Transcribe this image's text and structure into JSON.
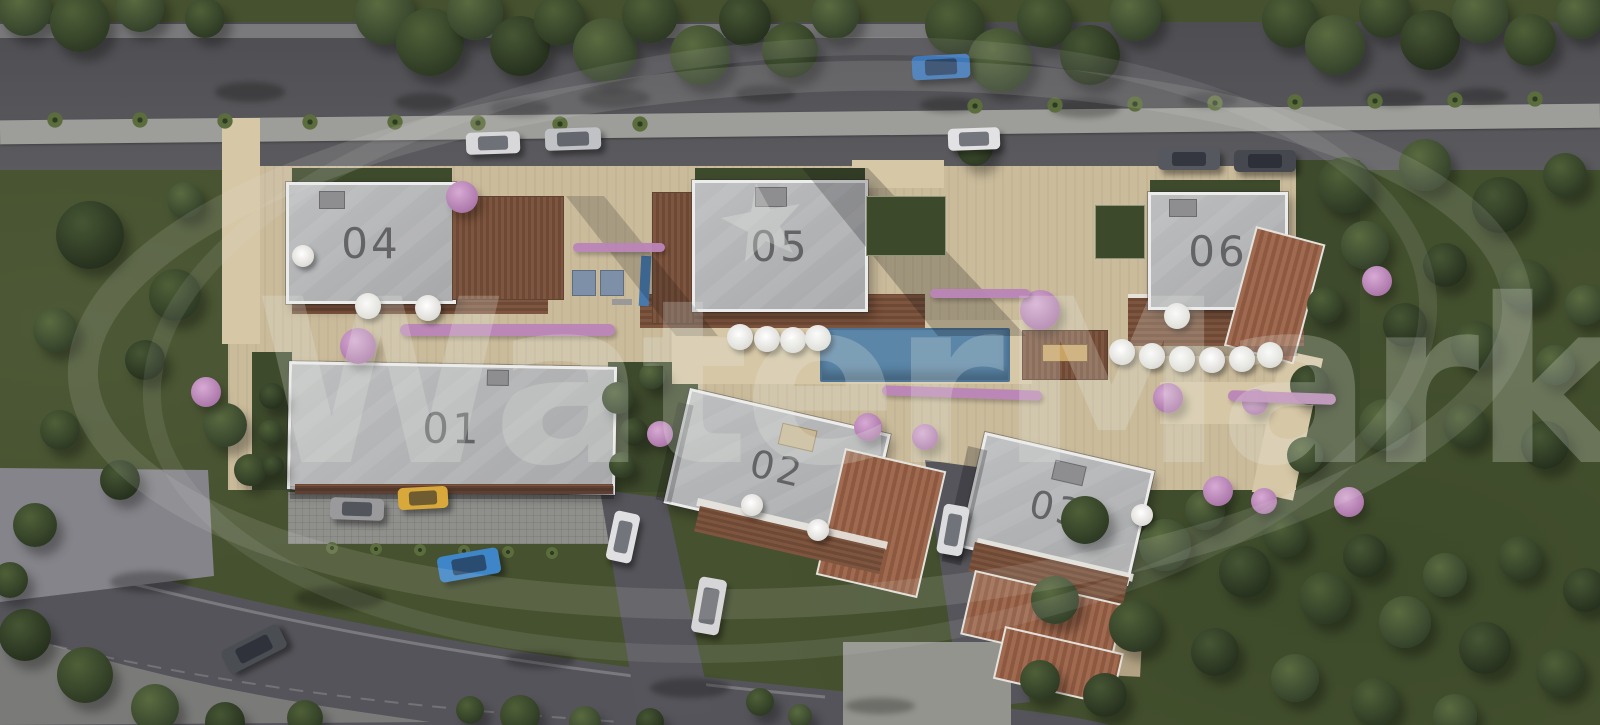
{
  "title": "Aerial masterplan render of residential complex",
  "watermark": {
    "text": "WaterMark",
    "star_on_building": "05"
  },
  "buildings": [
    {
      "id": "building-01",
      "label": "01"
    },
    {
      "id": "building-02",
      "label": "02"
    },
    {
      "id": "building-03",
      "label": "03"
    },
    {
      "id": "building-04",
      "label": "04"
    },
    {
      "id": "building-05",
      "label": "05"
    },
    {
      "id": "building-06",
      "label": "06"
    }
  ],
  "palette": {
    "grass": "#46512f",
    "road": "#56565a",
    "roof_gray": "#b4b6b8",
    "deck_brown": "#7e553e",
    "tile_terracotta": "#9a654b",
    "paving_beige": "#cabb9b",
    "pool_blue": "#5b86a8",
    "blossom_pink": "#bb85b8",
    "umbrella_white": "#f2f1ee"
  },
  "scene": {
    "pool": {
      "x": 820,
      "y": 328,
      "w": 186,
      "h": 50
    },
    "trees": [
      [
        25,
        10,
        26,
        0
      ],
      [
        80,
        22,
        30,
        1
      ],
      [
        140,
        8,
        24,
        0
      ],
      [
        205,
        18,
        20,
        1
      ],
      [
        385,
        15,
        30,
        0
      ],
      [
        430,
        42,
        34,
        1
      ],
      [
        475,
        12,
        28,
        0
      ],
      [
        520,
        46,
        30,
        2
      ],
      [
        560,
        20,
        26,
        1
      ],
      [
        605,
        50,
        32,
        0
      ],
      [
        650,
        15,
        28,
        1
      ],
      [
        700,
        55,
        30,
        0
      ],
      [
        745,
        20,
        26,
        2
      ],
      [
        790,
        50,
        28,
        1
      ],
      [
        835,
        15,
        24,
        0
      ],
      [
        955,
        25,
        30,
        1
      ],
      [
        1000,
        60,
        32,
        0
      ],
      [
        1045,
        20,
        28,
        1
      ],
      [
        1090,
        55,
        30,
        2
      ],
      [
        1135,
        15,
        26,
        0
      ],
      [
        1290,
        20,
        28,
        1
      ],
      [
        1335,
        45,
        30,
        0
      ],
      [
        1385,
        12,
        26,
        1
      ],
      [
        1430,
        40,
        30,
        2
      ],
      [
        1480,
        15,
        28,
        0
      ],
      [
        1530,
        40,
        26,
        1
      ],
      [
        1580,
        15,
        24,
        0
      ],
      [
        90,
        235,
        34,
        2
      ],
      [
        175,
        295,
        26,
        1
      ],
      [
        55,
        330,
        22,
        0
      ],
      [
        145,
        360,
        20,
        2
      ],
      [
        60,
        430,
        20,
        1
      ],
      [
        225,
        425,
        22,
        0
      ],
      [
        120,
        480,
        20,
        2
      ],
      [
        35,
        525,
        22,
        1
      ],
      [
        185,
        200,
        18,
        0
      ],
      [
        250,
        470,
        16,
        1
      ],
      [
        272,
        396,
        13,
        2
      ],
      [
        270,
        432,
        12,
        1
      ],
      [
        273,
        466,
        11,
        2
      ],
      [
        618,
        398,
        16,
        1
      ],
      [
        634,
        432,
        14,
        2
      ],
      [
        652,
        376,
        13,
        0
      ],
      [
        622,
        465,
        13,
        1
      ],
      [
        1345,
        185,
        28,
        1
      ],
      [
        1425,
        165,
        26,
        0
      ],
      [
        1500,
        205,
        28,
        2
      ],
      [
        1565,
        175,
        22,
        1
      ],
      [
        1365,
        245,
        24,
        0
      ],
      [
        1445,
        265,
        22,
        2
      ],
      [
        1525,
        285,
        26,
        1
      ],
      [
        1585,
        305,
        20,
        0
      ],
      [
        1405,
        325,
        22,
        2
      ],
      [
        1475,
        345,
        24,
        1
      ],
      [
        1555,
        365,
        20,
        0
      ],
      [
        1325,
        305,
        18,
        1
      ],
      [
        1310,
        385,
        20,
        2
      ],
      [
        1385,
        425,
        26,
        0
      ],
      [
        1465,
        425,
        22,
        1
      ],
      [
        1545,
        445,
        24,
        2
      ],
      [
        1305,
        455,
        18,
        0
      ],
      [
        975,
        148,
        18,
        1
      ],
      [
        1085,
        520,
        24,
        1
      ],
      [
        1165,
        545,
        26,
        0
      ],
      [
        1245,
        572,
        26,
        2
      ],
      [
        1325,
        598,
        26,
        1
      ],
      [
        1405,
        622,
        26,
        0
      ],
      [
        1485,
        648,
        26,
        2
      ],
      [
        1560,
        672,
        24,
        1
      ],
      [
        1055,
        600,
        24,
        0
      ],
      [
        1135,
        626,
        26,
        1
      ],
      [
        1215,
        652,
        24,
        2
      ],
      [
        1295,
        678,
        24,
        0
      ],
      [
        1375,
        702,
        24,
        1
      ],
      [
        1455,
        716,
        22,
        0
      ],
      [
        1105,
        695,
        22,
        2
      ],
      [
        1040,
        680,
        20,
        1
      ],
      [
        1205,
        510,
        20,
        0
      ],
      [
        1285,
        535,
        22,
        1
      ],
      [
        1365,
        556,
        22,
        2
      ],
      [
        1445,
        575,
        22,
        0
      ],
      [
        1520,
        558,
        22,
        1
      ],
      [
        1585,
        590,
        22,
        2
      ],
      [
        25,
        635,
        26,
        2
      ],
      [
        85,
        675,
        28,
        1
      ],
      [
        155,
        708,
        24,
        0
      ],
      [
        10,
        580,
        18,
        1
      ],
      [
        225,
        722,
        20,
        2
      ],
      [
        305,
        718,
        18,
        1
      ],
      [
        520,
        715,
        20,
        1
      ],
      [
        585,
        722,
        16,
        0
      ],
      [
        650,
        722,
        14,
        2
      ],
      [
        470,
        710,
        14,
        1
      ],
      [
        760,
        702,
        14,
        1
      ],
      [
        800,
        716,
        12,
        0
      ]
    ],
    "pink_trees": [
      [
        462,
        197,
        16
      ],
      [
        358,
        346,
        18
      ],
      [
        206,
        392,
        15
      ],
      [
        1040,
        310,
        20
      ],
      [
        868,
        427,
        14
      ],
      [
        925,
        437,
        13
      ],
      [
        1168,
        398,
        15
      ],
      [
        1255,
        402,
        13
      ],
      [
        1377,
        281,
        15
      ],
      [
        1218,
        491,
        15
      ],
      [
        1264,
        501,
        13
      ],
      [
        1349,
        502,
        15
      ],
      [
        660,
        434,
        13
      ]
    ],
    "palm_trees": [
      [
        55,
        120,
        9
      ],
      [
        140,
        120,
        9
      ],
      [
        225,
        121,
        9
      ],
      [
        310,
        122,
        9
      ],
      [
        395,
        122,
        9
      ],
      [
        478,
        123,
        9
      ],
      [
        560,
        124,
        9
      ],
      [
        640,
        124,
        9
      ],
      [
        975,
        106,
        9
      ],
      [
        1055,
        105,
        9
      ],
      [
        1135,
        104,
        9
      ],
      [
        1215,
        103,
        9
      ],
      [
        1295,
        102,
        9
      ],
      [
        1375,
        101,
        9
      ],
      [
        1455,
        100,
        9
      ],
      [
        1535,
        99,
        9
      ],
      [
        332,
        548,
        7
      ],
      [
        376,
        549,
        7
      ],
      [
        420,
        550,
        7
      ],
      [
        464,
        551,
        7
      ],
      [
        508,
        552,
        7
      ],
      [
        552,
        553,
        7
      ]
    ],
    "umbrellas": [
      [
        303,
        256,
        11
      ],
      [
        368,
        306,
        13
      ],
      [
        428,
        308,
        13
      ],
      [
        740,
        337,
        13
      ],
      [
        767,
        339,
        13
      ],
      [
        793,
        340,
        13
      ],
      [
        818,
        338,
        13
      ],
      [
        1122,
        352,
        13
      ],
      [
        1152,
        356,
        13
      ],
      [
        1182,
        359,
        13
      ],
      [
        1212,
        360,
        13
      ],
      [
        1242,
        359,
        13
      ],
      [
        1270,
        355,
        13
      ],
      [
        1177,
        316,
        13
      ],
      [
        752,
        505,
        11
      ],
      [
        818,
        530,
        11
      ],
      [
        1142,
        515,
        11
      ]
    ],
    "hedges": [
      [
        400,
        324,
        215,
        12,
        0
      ],
      [
        573,
        243,
        92,
        9,
        0
      ],
      [
        930,
        289,
        100,
        9,
        0
      ],
      [
        882,
        388,
        160,
        10,
        2
      ],
      [
        1228,
        392,
        108,
        11,
        2
      ]
    ],
    "planters": [
      [
        866,
        196,
        78,
        58
      ],
      [
        1095,
        205,
        48,
        52
      ]
    ],
    "ground_shadows": [
      [
        250,
        92,
        70,
        20
      ],
      [
        425,
        102,
        60,
        18
      ],
      [
        615,
        98,
        70,
        20
      ],
      [
        765,
        94,
        60,
        18
      ],
      [
        1085,
        108,
        70,
        20
      ],
      [
        1395,
        98,
        60,
        18
      ],
      [
        520,
        108,
        60,
        18
      ],
      [
        950,
        105,
        60,
        16
      ],
      [
        1210,
        100,
        56,
        16
      ],
      [
        1480,
        96,
        56,
        16
      ],
      [
        340,
        598,
        90,
        24
      ],
      [
        150,
        582,
        80,
        22
      ],
      [
        690,
        688,
        80,
        20
      ],
      [
        540,
        660,
        70,
        18
      ],
      [
        880,
        706,
        70,
        16
      ]
    ],
    "cars": [
      {
        "name": "car-white-top-1",
        "x": 466,
        "y": 132,
        "w": 54,
        "h": 22,
        "rot": -2,
        "color": "#d8d8da"
      },
      {
        "name": "car-silver-top",
        "x": 545,
        "y": 128,
        "w": 56,
        "h": 22,
        "rot": -2,
        "color": "#c0c2c6"
      },
      {
        "name": "car-blue-top",
        "x": 912,
        "y": 55,
        "w": 58,
        "h": 24,
        "rot": -3,
        "color": "#3f78b8"
      },
      {
        "name": "car-white-top-2",
        "x": 948,
        "y": 128,
        "w": 52,
        "h": 22,
        "rot": -2,
        "color": "#e2e2e4"
      },
      {
        "name": "car-dark-top-1",
        "x": 1158,
        "y": 148,
        "w": 62,
        "h": 22,
        "rot": 0,
        "color": "#55585e"
      },
      {
        "name": "car-dark-top-2",
        "x": 1234,
        "y": 150,
        "w": 62,
        "h": 22,
        "rot": 0,
        "color": "#45484e"
      },
      {
        "name": "car-gray-parked",
        "x": 330,
        "y": 498,
        "w": 54,
        "h": 22,
        "rot": 2,
        "color": "#9a9a9c"
      },
      {
        "name": "car-yellow",
        "x": 398,
        "y": 487,
        "w": 50,
        "h": 22,
        "rot": -3,
        "color": "#d8a93a"
      },
      {
        "name": "car-blue-bottom",
        "x": 438,
        "y": 552,
        "w": 62,
        "h": 26,
        "rot": -10,
        "color": "#3f86c8"
      },
      {
        "name": "car-dark-bottom",
        "x": 222,
        "y": 636,
        "w": 64,
        "h": 26,
        "rot": -27,
        "color": "#4a4d52"
      },
      {
        "name": "car-white-road-1",
        "x": 610,
        "y": 512,
        "w": 26,
        "h": 50,
        "rot": 12,
        "color": "#e0e0e2"
      },
      {
        "name": "car-white-road-2",
        "x": 695,
        "y": 578,
        "w": 28,
        "h": 56,
        "rot": 10,
        "color": "#d6d6d8"
      },
      {
        "name": "car-white-road-3",
        "x": 940,
        "y": 505,
        "w": 26,
        "h": 50,
        "rot": 10,
        "color": "#dcdcde"
      }
    ]
  }
}
